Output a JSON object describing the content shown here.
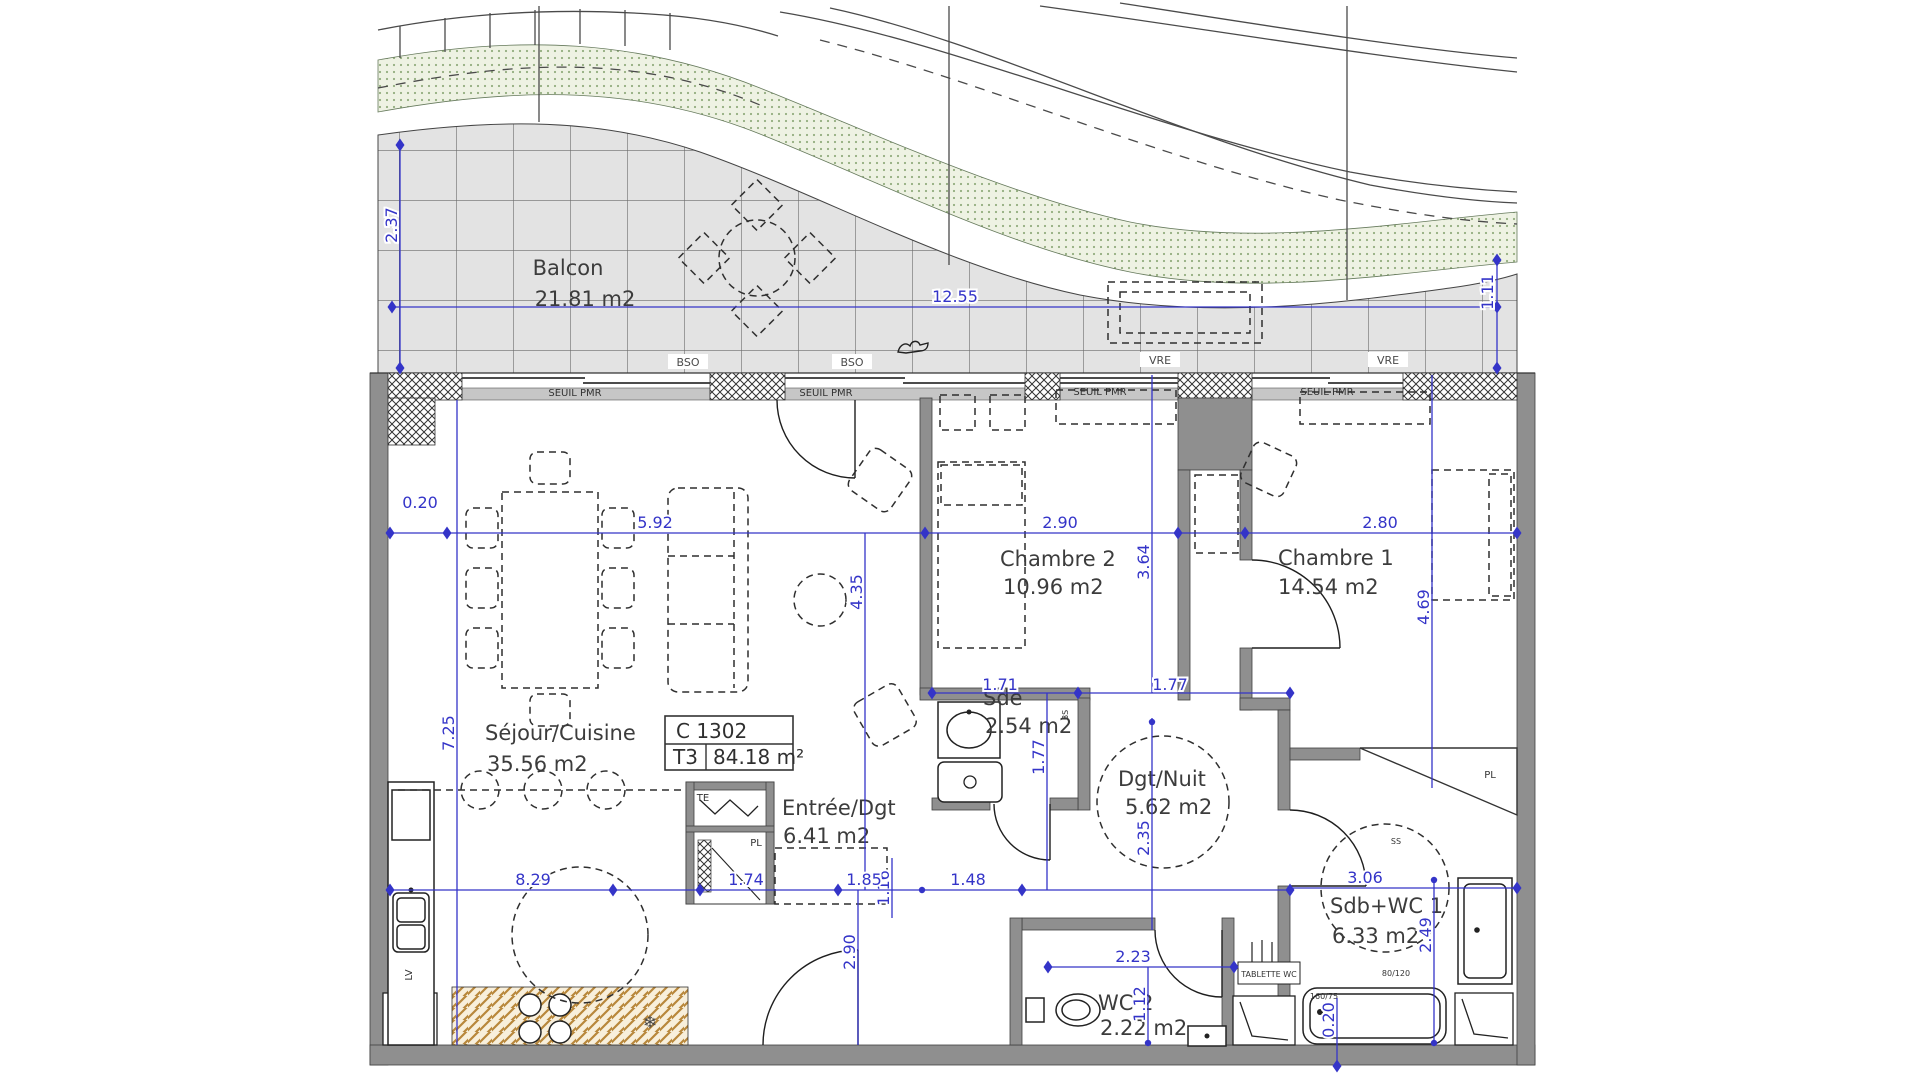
{
  "title_block": {
    "unit": "C 1302",
    "type": "T3",
    "area": "84.18 m²"
  },
  "rooms": {
    "balcon": {
      "name": "Balcon",
      "area": "21.81 m2"
    },
    "sejour": {
      "name": "Séjour/Cuisine",
      "area": "35.56 m2"
    },
    "chambre2": {
      "name": "Chambre 2",
      "area": "10.96 m2"
    },
    "chambre1": {
      "name": "Chambre 1",
      "area": "14.54 m2"
    },
    "sde": {
      "name": "Sde",
      "area": "2.54 m2"
    },
    "dgt": {
      "name": "Dgt/Nuit",
      "area": "5.62 m2"
    },
    "entree": {
      "name": "Entrée/Dgt",
      "area": "6.41 m2"
    },
    "wc2": {
      "name": "WC 2",
      "area": "2.22 m2"
    },
    "sdb": {
      "name": "Sdb+WC 1",
      "area": "6.33 m2"
    }
  },
  "dims": {
    "balcon_w": "12.55",
    "balcon_d_left": "2.37",
    "balcon_d_right": "1.11",
    "offset_left": "0.20",
    "sejour_w": "5.92",
    "ch2_w": "2.90",
    "ch1_w": "2.80",
    "sejour_h": "7.25",
    "entree_v": "4.35",
    "ch2_h": "3.64",
    "ch1_h": "4.69",
    "sde_w": "1.71",
    "dgt_w": "1.77",
    "sde_h": "1.77",
    "dgt_h": "2.35",
    "kitchen_w": "8.29",
    "hall_a": "1.74",
    "hall_b": "1.85",
    "hall_c": "1.48",
    "hall_v": "1.16",
    "entree_low_h": "2.90",
    "sdb_w": "3.06",
    "sdb_h": "2.49",
    "wc2_w": "2.23",
    "wc2_h": "1.12",
    "tub_off": "0.20",
    "door_reserve": "120x220"
  },
  "labels": {
    "bso": "BSO",
    "vre": "VRE",
    "seuil": "SEUIL PMR",
    "te": "TE",
    "pl": "PL",
    "lv": "LV",
    "bs": "BS",
    "ss": "SS",
    "tablette": "TABLETTE WC",
    "bathtub_size": "160/75",
    "shower_size": "80/120",
    "freezer_icon": "❄"
  },
  "colors": {
    "dimension": "#3434c8",
    "wall": "#8f8f8f",
    "tile": "#e3e3e3",
    "green": "#eef2e3",
    "hatch": "#b8873b"
  }
}
